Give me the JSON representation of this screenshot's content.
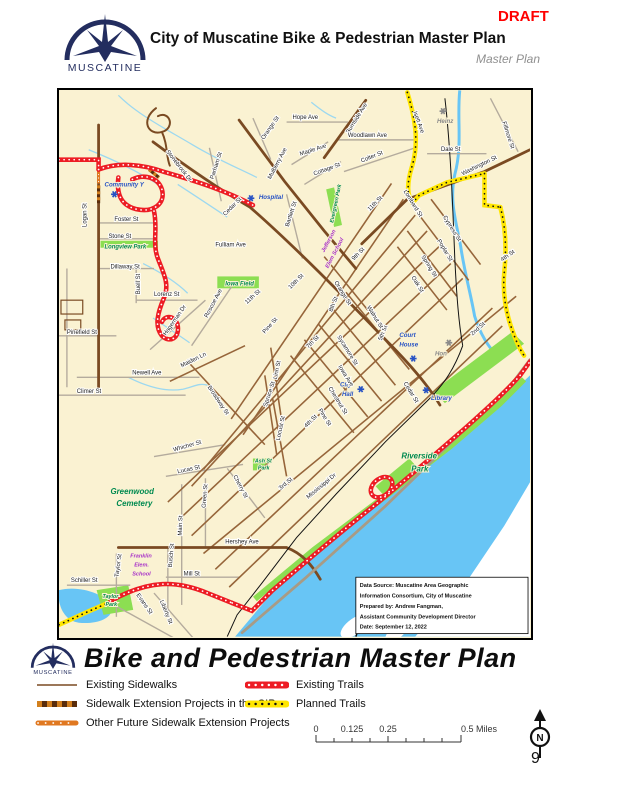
{
  "header": {
    "draft": "DRAFT",
    "title": "City of Muscatine Bike & Pedestrian Master Plan",
    "subtitle": "Master Plan",
    "logo_text": "MUSCATINE"
  },
  "footer": {
    "title": "Bike and Pedestrian Master Plan",
    "logo_text": "MUSCATINE"
  },
  "legend": {
    "left": [
      {
        "label": "Existing Sidewalks",
        "swatch": "existing-sidewalk"
      },
      {
        "label": "Sidewalk Extension Projects in the CIP",
        "swatch": "cip-sidewalk"
      },
      {
        "label": "Other Future Sidewalk Extension Projects",
        "swatch": "future-sidewalk"
      }
    ],
    "right": [
      {
        "label": "Existing Trails",
        "swatch": "existing-trail"
      },
      {
        "label": "Planned Trails",
        "swatch": "planned-trail"
      }
    ]
  },
  "scalebar": {
    "labels": [
      "0",
      "0.125",
      "0.25",
      "0.5 Miles"
    ]
  },
  "north_label": "N",
  "page_number": "9",
  "colors": {
    "accent_red": "#ff0000",
    "navy": "#232d5f",
    "map_bg": "#FAF2D2",
    "water": "#68C5F5",
    "park_green": "#8CDE52",
    "trail_red": "#ED1C24",
    "trail_yellow": "#FFE600",
    "road_brown": "#7a4a22"
  },
  "map": {
    "credits": [
      "Data Source: Muscatine Area Geographic",
      "Information Consortium, City of Muscatine",
      "Prepared by: Andrew Fangman,",
      "Assistant Community Development Director",
      "Date: September 12, 2022"
    ],
    "labels": [
      [
        "Stonebrook Dr",
        108,
        62,
        52,
        "lb-st"
      ],
      [
        "Burnside Ave",
        293,
        44,
        -58,
        "lb-st"
      ],
      [
        "Orange St",
        207,
        50,
        -55,
        "lb-st"
      ],
      [
        "Hope Ave",
        236,
        29,
        0,
        "lb-st"
      ],
      [
        "Mulberry Ave",
        214,
        90,
        -62,
        "lb-st"
      ],
      [
        "Maple Ave",
        244,
        66,
        -18,
        "lb-st"
      ],
      [
        "Parham St",
        156,
        90,
        -72,
        "lb-st"
      ],
      [
        "Cedar St",
        168,
        127,
        -45,
        "lb-st"
      ],
      [
        "Community Y",
        46,
        97,
        0,
        "lb-poi"
      ],
      [
        "Hospital",
        202,
        110,
        0,
        "lb-poi"
      ],
      [
        "Logan St",
        28,
        138,
        -90,
        "lb-st"
      ],
      [
        "Foster St",
        56,
        132,
        0,
        "lb-st"
      ],
      [
        "Stone St",
        50,
        149,
        0,
        "lb-st"
      ],
      [
        "Longview Park",
        46,
        160,
        0,
        "lb-park"
      ],
      [
        "Fulliam Ave",
        158,
        158,
        0,
        "lb-st"
      ],
      [
        "Dillaway St",
        52,
        180,
        0,
        "lb-st"
      ],
      [
        "Lorenz St",
        96,
        208,
        0,
        "lb-st"
      ],
      [
        "Buell St",
        82,
        206,
        -90,
        "lb-st"
      ],
      [
        "Pinefield St",
        8,
        246,
        0,
        "lb-st"
      ],
      [
        "Hagerman Dr",
        108,
        248,
        -55,
        "lb-st"
      ],
      [
        "Roscoe Ave",
        150,
        230,
        -62,
        "lb-st"
      ],
      [
        "Iowa Field",
        168,
        197,
        0,
        "lb-park"
      ],
      [
        "11th St",
        190,
        216,
        -42,
        "lb-st"
      ],
      [
        "10th St",
        234,
        201,
        -45,
        "lb-st"
      ],
      [
        "11th St",
        314,
        122,
        -45,
        "lb-st"
      ],
      [
        "Pine St",
        208,
        246,
        -48,
        "lb-st"
      ],
      [
        "7th St",
        252,
        261,
        -45,
        "lb-st"
      ],
      [
        "Linn St",
        220,
        292,
        -78,
        "lb-st"
      ],
      [
        "Spruce St",
        210,
        320,
        -72,
        "lb-st"
      ],
      [
        "Maiden Ln",
        124,
        280,
        -26,
        "lb-st"
      ],
      [
        "Newell Ave",
        74,
        287,
        0,
        "lb-st"
      ],
      [
        "Climer St",
        18,
        306,
        0,
        "lb-st"
      ],
      [
        "Broadway St",
        150,
        300,
        56,
        "lb-st"
      ],
      [
        "Locust St",
        223,
        354,
        -78,
        "lb-st"
      ],
      [
        "4th St",
        250,
        341,
        -45,
        "lb-st"
      ],
      [
        "Whicher St",
        116,
        365,
        -16,
        "lb-st"
      ],
      [
        "Lucas St",
        120,
        387,
        -12,
        "lb-st"
      ],
      [
        "Cherry St",
        176,
        390,
        62,
        "lb-st"
      ],
      [
        "3rd St",
        224,
        404,
        -40,
        "lb-st"
      ],
      [
        "Ash St",
        198,
        376,
        0,
        "lb-park-sm"
      ],
      [
        "Park",
        201,
        383,
        0,
        "lb-park-sm"
      ],
      [
        "Mississippi Dr",
        252,
        413,
        -40,
        "lb-st"
      ],
      [
        "Greenwood",
        52,
        408,
        0,
        "lb-park-lg"
      ],
      [
        "Cemetery",
        58,
        420,
        0,
        "lb-park-lg"
      ],
      [
        "Green St",
        148,
        422,
        -85,
        "lb-st"
      ],
      [
        "Main St",
        124,
        450,
        -88,
        "lb-st"
      ],
      [
        "Hershey Ave",
        168,
        458,
        0,
        "lb-st"
      ],
      [
        "Franklin",
        72,
        472,
        0,
        "lb-school"
      ],
      [
        "Elem.",
        76,
        481,
        0,
        "lb-school"
      ],
      [
        "School",
        74,
        490,
        0,
        "lb-school"
      ],
      [
        "Schiller St",
        12,
        497,
        0,
        "lb-st"
      ],
      [
        "Taylor St",
        60,
        492,
        -82,
        "lb-st"
      ],
      [
        "Busch St",
        114,
        482,
        -85,
        "lb-st"
      ],
      [
        "Mill St",
        126,
        490,
        0,
        "lb-st"
      ],
      [
        "Evans St",
        78,
        510,
        55,
        "lb-st"
      ],
      [
        "Liberty St",
        102,
        516,
        68,
        "lb-st"
      ],
      [
        "Taylor",
        44,
        513,
        0,
        "lb-park-sm"
      ],
      [
        "Park",
        47,
        521,
        0,
        "lb-park-sm"
      ],
      [
        "Court",
        344,
        249,
        0,
        "lb-poi"
      ],
      [
        "House",
        344,
        259,
        0,
        "lb-poi"
      ],
      [
        "Hon",
        380,
        268,
        0,
        "lb-gray"
      ],
      [
        "City",
        284,
        299,
        0,
        "lb-poi"
      ],
      [
        "Hall",
        286,
        309,
        0,
        "lb-poi"
      ],
      [
        "Library",
        376,
        313,
        0,
        "lb-poi"
      ],
      [
        "2nd St",
        418,
        248,
        -42,
        "lb-st"
      ],
      [
        "Riverside",
        346,
        372,
        0,
        "lb-park-lg"
      ],
      [
        "Park",
        356,
        385,
        0,
        "lb-park-lg"
      ],
      [
        "Heinz",
        382,
        33,
        0,
        "lb-gray"
      ],
      [
        "Isett Ave",
        358,
        22,
        70,
        "lb-st"
      ],
      [
        "Woodlawn Ave",
        292,
        47,
        0,
        "lb-st"
      ],
      [
        "Dale St",
        386,
        61,
        0,
        "lb-st"
      ],
      [
        "Colter St",
        306,
        73,
        -22,
        "lb-st"
      ],
      [
        "Washington St",
        408,
        86,
        -26,
        "lb-st"
      ],
      [
        "Fillmore St",
        448,
        32,
        72,
        "lb-st"
      ],
      [
        "Lombard St",
        348,
        102,
        58,
        "lb-st"
      ],
      [
        "Cypress St",
        388,
        128,
        58,
        "lb-st"
      ],
      [
        "Poplar St",
        382,
        152,
        58,
        "lb-st"
      ],
      [
        "Spring St",
        366,
        168,
        58,
        "lb-st"
      ],
      [
        "Oak St",
        356,
        189,
        58,
        "lb-st"
      ],
      [
        "Orange St",
        278,
        194,
        58,
        "lb-st"
      ],
      [
        "4th St",
        448,
        173,
        -35,
        "lb-st"
      ],
      [
        "9th St",
        298,
        172,
        -45,
        "lb-st"
      ],
      [
        "8th St",
        276,
        224,
        -68,
        "lb-st"
      ],
      [
        "Sycamore St",
        281,
        249,
        58,
        "lb-st"
      ],
      [
        "5th St",
        326,
        253,
        -68,
        "lb-st"
      ],
      [
        "Iowa Ave",
        282,
        279,
        58,
        "lb-st"
      ],
      [
        "Chestnut St",
        272,
        301,
        58,
        "lb-st"
      ],
      [
        "Pine St",
        262,
        323,
        58,
        "lb-st"
      ],
      [
        "Walnut St",
        311,
        219,
        58,
        "lb-st"
      ],
      [
        "Cedar St",
        348,
        296,
        58,
        "lb-st"
      ],
      [
        "Bartlett St",
        232,
        138,
        -72,
        "lb-st"
      ],
      [
        "Cottage St",
        258,
        86,
        -20,
        "lb-st"
      ],
      [
        "Evergreen Park",
        277,
        134,
        -78,
        "lb-park-sm"
      ],
      [
        "Jefferson",
        268,
        164,
        -62,
        "lb-school"
      ],
      [
        "Elem School",
        272,
        180,
        -62,
        "lb-school"
      ]
    ],
    "symbols": [
      {
        "x": 56,
        "y": 105,
        "c": "#2853c4"
      },
      {
        "x": 194,
        "y": 109,
        "c": "#2853c4"
      },
      {
        "x": 358,
        "y": 271,
        "c": "#2853c4"
      },
      {
        "x": 305,
        "y": 302,
        "c": "#2853c4"
      },
      {
        "x": 371,
        "y": 303,
        "c": "#2853c4"
      },
      {
        "x": 388,
        "y": 21,
        "c": "#8a8a8a"
      },
      {
        "x": 394,
        "y": 255,
        "c": "#8a8a8a"
      }
    ]
  }
}
